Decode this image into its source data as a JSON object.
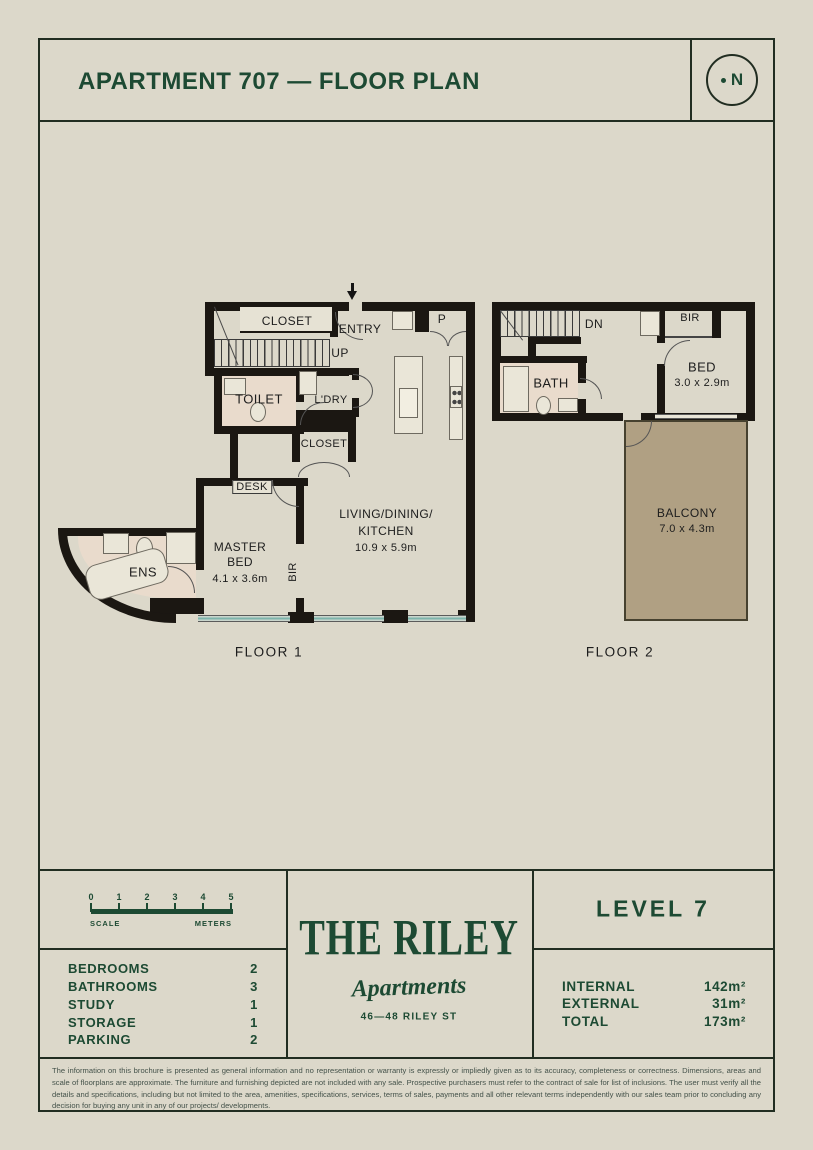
{
  "colors": {
    "accent_green": "#1d4a33",
    "wall_black": "#1b1712",
    "background_cream": "#dcd8ca",
    "bathroom_tint": "#e9dbcc",
    "balcony_tan": "#b0a083",
    "window_teal": "#7db4ab"
  },
  "header": {
    "title": "APARTMENT 707 — FLOOR PLAN",
    "compass": "N"
  },
  "plan": {
    "floor1": {
      "caption": "FLOOR 1",
      "closet": "CLOSET",
      "entry": "ENTRY",
      "up": "UP",
      "pantry": "P",
      "toilet": "TOILET",
      "laundry": "L'DRY",
      "closet2": "CLOSET",
      "desk": "DESK",
      "master": {
        "l1": "MASTER",
        "l2": "BED",
        "dims": "4.1 x 3.6m"
      },
      "bir": "BIR",
      "living": {
        "l1": "LIVING/DINING/",
        "l2": "KITCHEN",
        "dims": "10.9 x 5.9m"
      },
      "ens": "ENS"
    },
    "floor2": {
      "caption": "FLOOR 2",
      "down": "DN",
      "bir": "BIR",
      "bed": {
        "l1": "BED",
        "dims": "3.0 x 2.9m"
      },
      "bath": "BATH",
      "balcony": {
        "l1": "BALCONY",
        "dims": "7.0 x 4.3m"
      }
    }
  },
  "scalebar": {
    "ticks": [
      "0",
      "1",
      "2",
      "3",
      "4",
      "5"
    ],
    "left_label": "SCALE",
    "right_label": "METERS"
  },
  "stats": [
    {
      "label": "BEDROOMS",
      "value": "2"
    },
    {
      "label": "BATHROOMS",
      "value": "3"
    },
    {
      "label": "STUDY",
      "value": "1"
    },
    {
      "label": "STORAGE",
      "value": "1"
    },
    {
      "label": "PARKING",
      "value": "2"
    }
  ],
  "logo": {
    "name": "THE RILEY",
    "sub": "Apartments",
    "address": "46—48 RILEY ST"
  },
  "level": {
    "title": "LEVEL 7"
  },
  "areas": [
    {
      "label": "INTERNAL",
      "value": "142m²"
    },
    {
      "label": "EXTERNAL",
      "value": "31m²"
    },
    {
      "label": "TOTAL",
      "value": "173m²"
    }
  ],
  "disclaimer": "The information on this brochure is presented as general information and no representation or warranty is expressly or impliedly given as to its accuracy, completeness or correctness. Dimensions, areas and scale of floorplans are approximate. The furniture and furnishing depicted are not included with any sale. Prospective purchasers must refer to the contract of sale for list of inclusions. The user must verify all the details and specifications, including but not limited to the area, amenities, specifications, services, terms of sales, payments and all other relevant terms independently with our sales team prior to concluding any decision for buying any unit in any of our projects/ developments."
}
